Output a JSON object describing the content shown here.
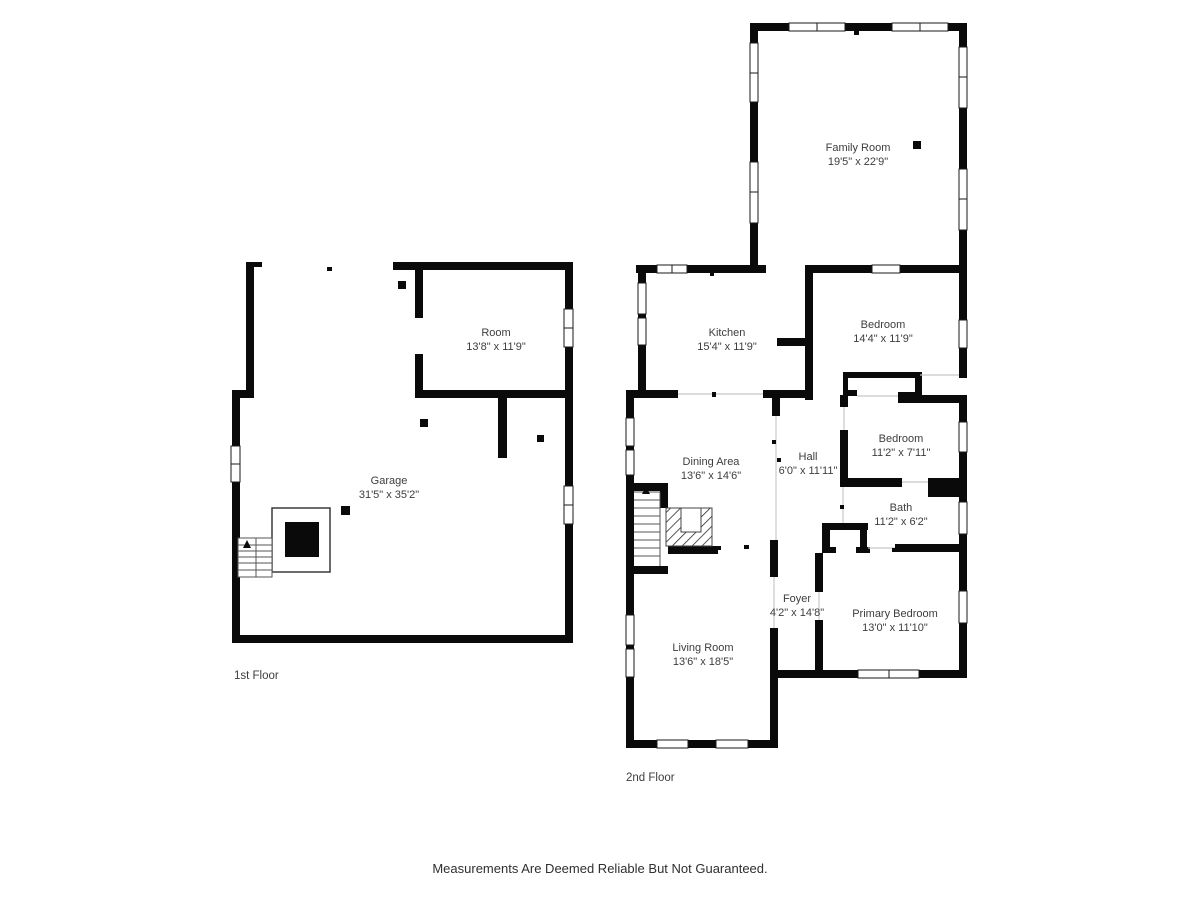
{
  "disclaimer": "Measurements Are Deemed Reliable But Not Guaranteed.",
  "floors": [
    {
      "label": "1st Floor"
    },
    {
      "label": "2nd Floor"
    }
  ],
  "rooms": [
    {
      "id": "family-room",
      "name": "Family Room",
      "dims": "19'5\" x 22'9\""
    },
    {
      "id": "room",
      "name": "Room",
      "dims": "13'8\" x 11'9\""
    },
    {
      "id": "kitchen",
      "name": "Kitchen",
      "dims": "15'4\" x 11'9\""
    },
    {
      "id": "bedroom-upper",
      "name": "Bedroom",
      "dims": "14'4\" x 11'9\""
    },
    {
      "id": "garage",
      "name": "Garage",
      "dims": "31'5\" x 35'2\""
    },
    {
      "id": "dining-area",
      "name": "Dining Area",
      "dims": "13'6\" x 14'6\""
    },
    {
      "id": "hall",
      "name": "Hall",
      "dims": "6'0\" x 11'11\""
    },
    {
      "id": "bedroom-middle",
      "name": "Bedroom",
      "dims": "11'2\" x 7'11\""
    },
    {
      "id": "bath",
      "name": "Bath",
      "dims": "11'2\" x 6'2\""
    },
    {
      "id": "foyer",
      "name": "Foyer",
      "dims": "4'2\" x 14'8\""
    },
    {
      "id": "primary-bedroom",
      "name": "Primary Bedroom",
      "dims": "13'0\" x 11'10\""
    },
    {
      "id": "living-room",
      "name": "Living Room",
      "dims": "13'6\" x 18'5\""
    }
  ],
  "colors": {
    "wall": "#0a0a0a",
    "background": "#ffffff",
    "text": "#3d3d3d",
    "open_line": "#c7c7c7"
  }
}
